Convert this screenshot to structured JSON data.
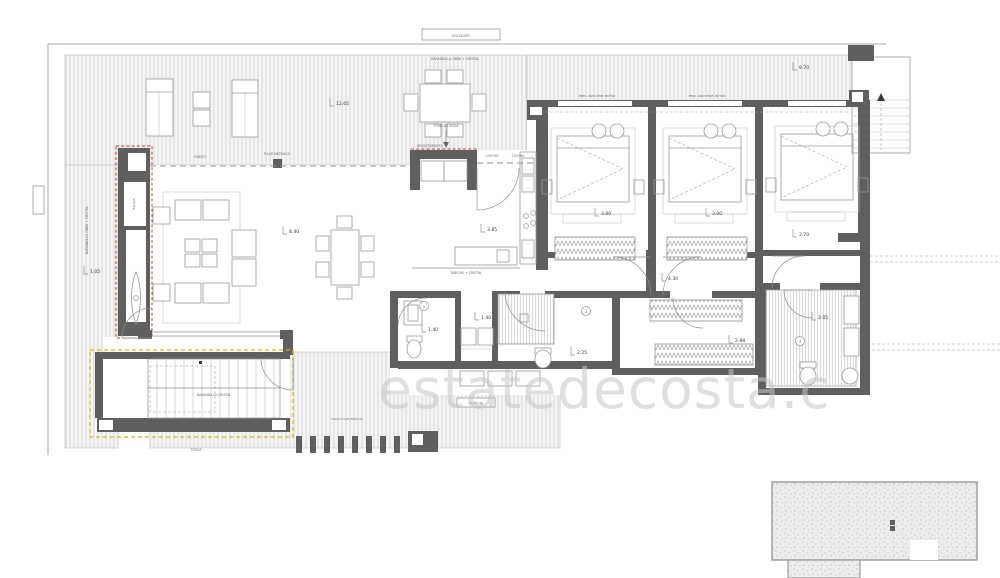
{
  "meta": {
    "type": "architectural-floor-plan",
    "watermark": "estatedecosta.c"
  },
  "colors": {
    "wall": "#5f5f5f",
    "accent_red": "#c63b2a",
    "accent_yellow": "#d9b60a",
    "hatch_line": "#d8d8d8",
    "drawing_line": "#8f8f8f",
    "watermark": "#c6c6c6"
  },
  "annotations": {
    "voladizo": "VOLADIZO",
    "barandilla_obra_top": "BARANDILLA OBRA + CRISTAL",
    "barandilla_obra_left": "BARANDILLA OBRA + CRISTAL",
    "barandilla_cristal": "BARANDILLA CRISTAL",
    "hueco": "HUECO",
    "pilar": "PILAR METÁLICO",
    "sill_a": "230+60",
    "sill_b": "230+60",
    "revestimiento_wall": "REVESTIMIENTO",
    "revestimiento_nook": "REVESTIMIENTO",
    "baldas": "BALDAS",
    "toma_agua": "TOMA DE AGUA",
    "pers_motor": "PERS. ABAT. PERF. MOTOR",
    "tabique": "TABIQUE + CRISTAL",
    "porche": "PORCHE",
    "tosca": "TOSCA",
    "vigas": "VIGAS H.LAM 300x110"
  },
  "dimensions": {
    "terrace_left": "12.65",
    "terrace_right": "9.70",
    "living": "8.40",
    "fireplace": "1.05",
    "kitchen": "3.85",
    "bed1": "3.00",
    "bed2": "3.00",
    "bed3": "2.70",
    "hall": "4.30",
    "aseo_w": "1.40",
    "aseo_d": "1.40",
    "bath2": "2.25",
    "dressing": "2.88",
    "bath3": "2.05"
  },
  "markers": {
    "m1": "1",
    "m2": "2",
    "m3": "3"
  }
}
